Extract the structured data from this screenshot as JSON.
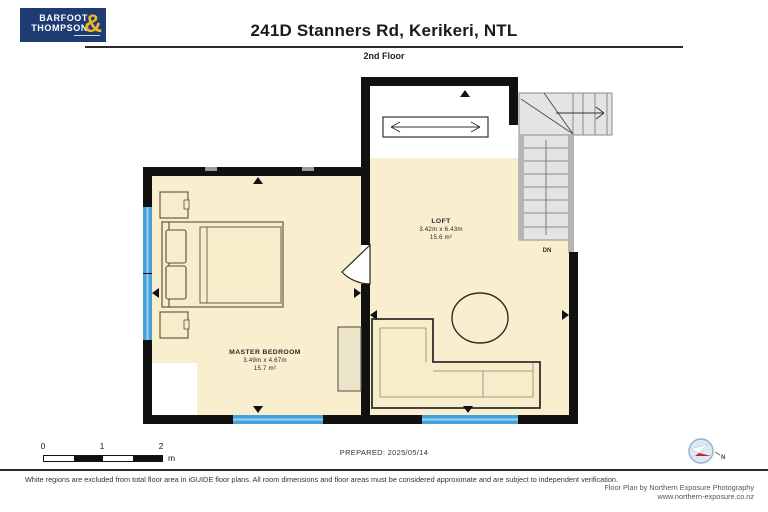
{
  "header": {
    "logo": {
      "line1": "BARFOOT",
      "line2": "THOMPSON",
      "amp": "&"
    },
    "title": "241D Stanners Rd, Kerikeri, NTL",
    "floor_label": "2nd Floor"
  },
  "plan": {
    "rooms": [
      {
        "name": "MASTER BEDROOM",
        "dims": "3.49m x 4.67m",
        "area": "15.7 m²"
      },
      {
        "name": "LOFT",
        "dims": "3.42m x 6.43m",
        "area": "15.6 m²"
      }
    ],
    "stairs_label": "DN"
  },
  "footer": {
    "scale": {
      "ticks": [
        "0",
        "1",
        "2"
      ],
      "unit": "m"
    },
    "prepared": "PREPARED: 2025/05/14",
    "compass_label": "N",
    "disclaimer": "White regions are excluded from total floor area in iGUIDE floor plans. All room dimensions and floor areas must be considered approximate and are subject to independent verification.",
    "credit1": "Floor Plan by Northern Exposure Photography",
    "credit2": "www.northern-exposure.co.nz"
  },
  "colors": {
    "brand_navy": "#1e3c72",
    "brand_gold": "#f0b428",
    "floor_beige": "#f9efce",
    "wall_black": "#111111",
    "window_blue": "#44a1d9",
    "stair_gray": "#e4e4e4",
    "compass_red": "#cc2222"
  }
}
